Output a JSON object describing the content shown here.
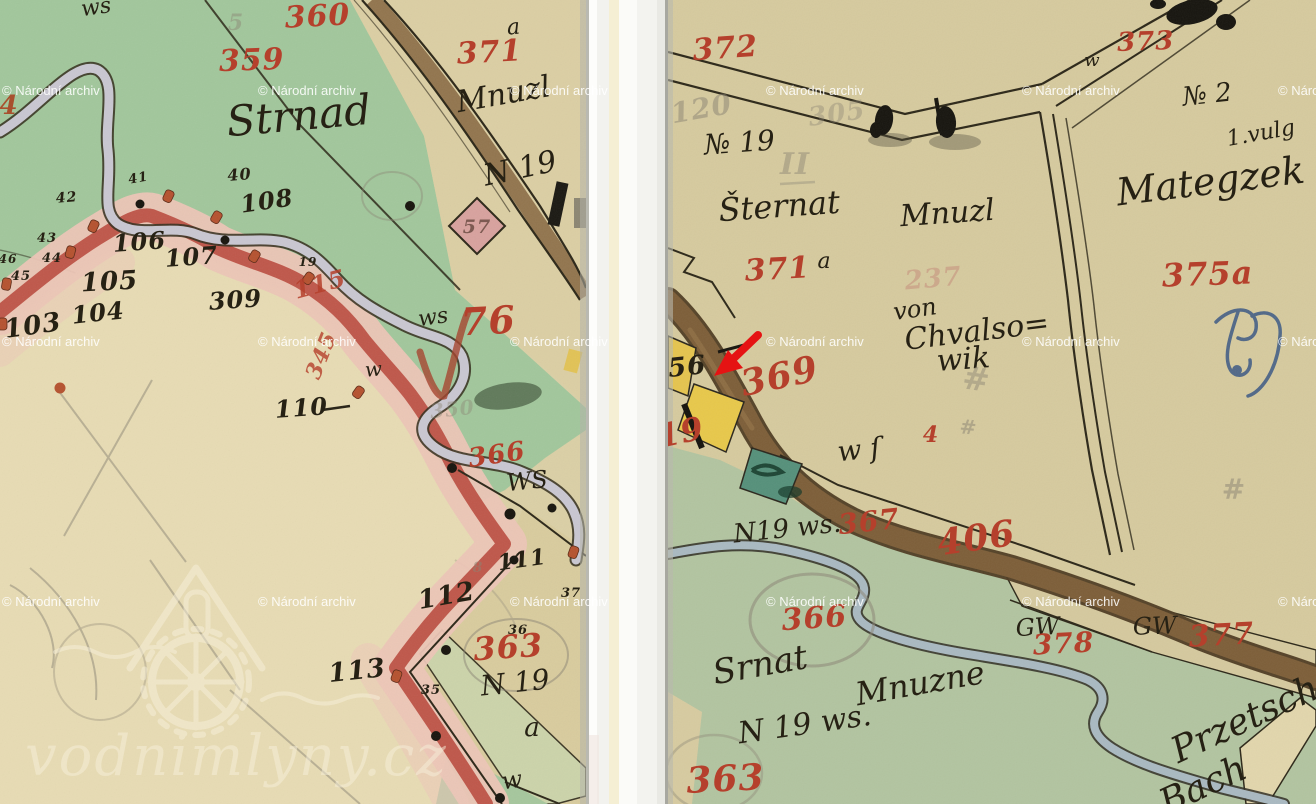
{
  "branding": {
    "archive_watermark": "© Národní archiv",
    "site_watermark": "vodnimlyny.cz"
  },
  "palette": {
    "red": "#b5402c",
    "black": "#262114",
    "pencil": "#8b8474",
    "pencil_red": "#c28376",
    "blue": "#3a5884",
    "rust": "#a8502e",
    "plum": "#7d5a52",
    "watermark": "#ffffff"
  },
  "annotation": {
    "arrow_color": "#e51313"
  },
  "watermarks": {
    "rows_y": [
      95,
      346,
      606
    ],
    "cols_x": [
      2,
      258,
      510,
      766,
      1022,
      1278
    ]
  },
  "map_labels": {
    "left": [
      {
        "t": "ws",
        "x": 97,
        "y": 14,
        "s": 22,
        "c": "black",
        "f": "hand",
        "r": -8
      },
      {
        "t": "5",
        "x": 236,
        "y": 30,
        "s": 22,
        "c": "pencil",
        "f": "num",
        "o": 0.45
      },
      {
        "t": "360",
        "x": 318,
        "y": 26,
        "s": 30,
        "c": "red",
        "f": "num",
        "r": -3
      },
      {
        "t": "a",
        "x": 514,
        "y": 34,
        "s": 22,
        "c": "black",
        "f": "hand",
        "r": -5
      },
      {
        "t": "371",
        "x": 490,
        "y": 62,
        "s": 30,
        "c": "red",
        "f": "num",
        "r": -3
      },
      {
        "t": "359",
        "x": 252,
        "y": 70,
        "s": 30,
        "c": "red",
        "f": "num",
        "r": -2
      },
      {
        "t": "Mnuzl",
        "x": 505,
        "y": 104,
        "s": 30,
        "c": "black",
        "f": "hand",
        "r": -10
      },
      {
        "t": "4",
        "x": 9,
        "y": 114,
        "s": 26,
        "c": "rust",
        "f": "num"
      },
      {
        "t": "Strnad",
        "x": 300,
        "y": 130,
        "s": 42,
        "c": "black",
        "f": "hand",
        "r": -5
      },
      {
        "t": "N 19",
        "x": 522,
        "y": 178,
        "s": 30,
        "c": "black",
        "f": "hand",
        "r": -12
      },
      {
        "t": "41",
        "x": 139,
        "y": 182,
        "s": 13,
        "c": "black",
        "f": "num",
        "r": -10
      },
      {
        "t": "40",
        "x": 240,
        "y": 180,
        "s": 16,
        "c": "black",
        "f": "num",
        "r": -5
      },
      {
        "t": "42",
        "x": 67,
        "y": 202,
        "s": 14,
        "c": "black",
        "f": "num",
        "r": -5
      },
      {
        "t": "108",
        "x": 268,
        "y": 209,
        "s": 24,
        "c": "black",
        "f": "num",
        "r": -8
      },
      {
        "t": "57",
        "x": 477,
        "y": 233,
        "s": 19,
        "c": "plum",
        "f": "num"
      },
      {
        "t": "43",
        "x": 47,
        "y": 242,
        "s": 13,
        "c": "black",
        "f": "num"
      },
      {
        "t": "106",
        "x": 140,
        "y": 250,
        "s": 24,
        "c": "black",
        "f": "num",
        "r": -4
      },
      {
        "t": "44",
        "x": 52,
        "y": 262,
        "s": 13,
        "c": "black",
        "f": "num"
      },
      {
        "t": "46",
        "x": 8,
        "y": 263,
        "s": 12,
        "c": "black",
        "f": "num"
      },
      {
        "t": "107",
        "x": 192,
        "y": 265,
        "s": 24,
        "c": "black",
        "f": "num",
        "r": -4
      },
      {
        "t": "19",
        "x": 308,
        "y": 266,
        "s": 12,
        "c": "black",
        "f": "num"
      },
      {
        "t": "45",
        "x": 21,
        "y": 280,
        "s": 13,
        "c": "black",
        "f": "num"
      },
      {
        "t": "105",
        "x": 110,
        "y": 290,
        "s": 26,
        "c": "black",
        "f": "num",
        "r": -3
      },
      {
        "t": "115",
        "x": 322,
        "y": 292,
        "s": 24,
        "c": "red",
        "f": "num",
        "r": -15,
        "o": 0.85
      },
      {
        "t": "309",
        "x": 236,
        "y": 308,
        "s": 24,
        "c": "black",
        "f": "num",
        "r": -4
      },
      {
        "t": "104",
        "x": 99,
        "y": 321,
        "s": 24,
        "c": "black",
        "f": "num",
        "r": -6
      },
      {
        "t": "ws",
        "x": 434,
        "y": 324,
        "s": 22,
        "c": "black",
        "f": "hand",
        "r": -8
      },
      {
        "t": "103",
        "x": 34,
        "y": 334,
        "s": 26,
        "c": "black",
        "f": "num",
        "r": -8
      },
      {
        "t": "76",
        "x": 489,
        "y": 334,
        "s": 38,
        "c": "red",
        "f": "num",
        "r": -3
      },
      {
        "t": "345",
        "x": 328,
        "y": 358,
        "s": 22,
        "c": "red",
        "f": "num",
        "r": -68,
        "o": 0.8
      },
      {
        "t": "w",
        "x": 374,
        "y": 376,
        "s": 20,
        "c": "black",
        "f": "hand",
        "r": -5
      },
      {
        "t": "110",
        "x": 302,
        "y": 416,
        "s": 24,
        "c": "black",
        "f": "num",
        "r": -4
      },
      {
        "t": "350",
        "x": 453,
        "y": 416,
        "s": 20,
        "c": "pencil",
        "f": "num",
        "r": -6,
        "o": 0.4
      },
      {
        "t": "366",
        "x": 498,
        "y": 463,
        "s": 26,
        "c": "red",
        "f": "num",
        "r": -8
      },
      {
        "t": "WS",
        "x": 528,
        "y": 489,
        "s": 24,
        "c": "black",
        "f": "hand",
        "r": -6
      },
      {
        "t": "111",
        "x": 523,
        "y": 567,
        "s": 22,
        "c": "black",
        "f": "num",
        "r": -8
      },
      {
        "t": "8",
        "x": 478,
        "y": 572,
        "s": 14,
        "c": "pencil",
        "f": "num",
        "o": 0.5
      },
      {
        "t": "112",
        "x": 448,
        "y": 604,
        "s": 26,
        "c": "black",
        "f": "num",
        "r": -10
      },
      {
        "t": "37",
        "x": 571,
        "y": 597,
        "s": 13,
        "c": "black",
        "f": "num"
      },
      {
        "t": "36",
        "x": 518,
        "y": 634,
        "s": 13,
        "c": "black",
        "f": "num"
      },
      {
        "t": "363",
        "x": 509,
        "y": 658,
        "s": 32,
        "c": "red",
        "f": "num",
        "r": -4
      },
      {
        "t": "35",
        "x": 431,
        "y": 694,
        "s": 13,
        "c": "black",
        "f": "num"
      },
      {
        "t": "113",
        "x": 358,
        "y": 679,
        "s": 26,
        "c": "black",
        "f": "num",
        "r": -6
      },
      {
        "t": "N 19",
        "x": 516,
        "y": 692,
        "s": 28,
        "c": "black",
        "f": "hand",
        "r": -6
      },
      {
        "t": "a",
        "x": 532,
        "y": 736,
        "s": 26,
        "c": "black",
        "f": "hand"
      },
      {
        "t": "w",
        "x": 513,
        "y": 788,
        "s": 24,
        "c": "black",
        "f": "hand",
        "r": -8
      }
    ],
    "right": [
      {
        "t": "372",
        "x": 726,
        "y": 58,
        "s": 30,
        "c": "red",
        "f": "num",
        "r": -4
      },
      {
        "t": "373",
        "x": 1146,
        "y": 50,
        "s": 26,
        "c": "red",
        "f": "num",
        "r": -2
      },
      {
        "t": "w",
        "x": 1092,
        "y": 66,
        "s": 18,
        "c": "black",
        "f": "hand"
      },
      {
        "t": "№ 2",
        "x": 1208,
        "y": 103,
        "s": 26,
        "c": "black",
        "f": "hand",
        "r": -6
      },
      {
        "t": "120",
        "x": 703,
        "y": 118,
        "s": 28,
        "c": "pencil",
        "f": "num",
        "r": -10,
        "o": 0.5
      },
      {
        "t": "305",
        "x": 838,
        "y": 122,
        "s": 26,
        "c": "pencil",
        "f": "num",
        "r": -8,
        "o": 0.38
      },
      {
        "t": "1.vulg",
        "x": 1262,
        "y": 140,
        "s": 22,
        "c": "black",
        "f": "hand",
        "r": -10
      },
      {
        "t": "№ 19",
        "x": 740,
        "y": 152,
        "s": 28,
        "c": "black",
        "f": "hand",
        "r": -4
      },
      {
        "t": "II",
        "x": 795,
        "y": 174,
        "s": 30,
        "c": "pencil",
        "f": "num",
        "o": 0.45
      },
      {
        "t": "Mategzek",
        "x": 1212,
        "y": 194,
        "s": 38,
        "c": "black",
        "f": "hand",
        "r": -7
      },
      {
        "t": "Šternat",
        "x": 780,
        "y": 217,
        "s": 32,
        "c": "black",
        "f": "hand",
        "r": -4
      },
      {
        "t": "Mnuzl",
        "x": 948,
        "y": 223,
        "s": 30,
        "c": "black",
        "f": "hand",
        "r": -4
      },
      {
        "t": "a",
        "x": 824,
        "y": 268,
        "s": 22,
        "c": "black",
        "f": "hand"
      },
      {
        "t": "371",
        "x": 778,
        "y": 279,
        "s": 30,
        "c": "red",
        "f": "num",
        "r": -3
      },
      {
        "t": "237",
        "x": 934,
        "y": 287,
        "s": 26,
        "c": "pencil_red",
        "f": "num",
        "r": -5,
        "o": 0.45
      },
      {
        "t": "375a",
        "x": 1208,
        "y": 285,
        "s": 32,
        "c": "red",
        "f": "num",
        "r": -2
      },
      {
        "t": "von",
        "x": 916,
        "y": 317,
        "s": 24,
        "c": "black",
        "f": "hand",
        "r": -8
      },
      {
        "t": "Chvalso=",
        "x": 978,
        "y": 341,
        "s": 30,
        "c": "black",
        "f": "hand",
        "r": -7
      },
      {
        "t": "wik",
        "x": 964,
        "y": 369,
        "s": 30,
        "c": "black",
        "f": "hand",
        "r": -4
      },
      {
        "t": "56",
        "x": 688,
        "y": 375,
        "s": 26,
        "c": "black",
        "f": "num",
        "r": -6
      },
      {
        "t": "369",
        "x": 782,
        "y": 388,
        "s": 36,
        "c": "red",
        "f": "num",
        "r": -12
      },
      {
        "t": "#",
        "x": 975,
        "y": 390,
        "s": 32,
        "c": "pencil",
        "f": "num",
        "r": 8,
        "o": 0.45
      },
      {
        "t": "19",
        "x": 683,
        "y": 443,
        "s": 32,
        "c": "red",
        "f": "num",
        "r": -12
      },
      {
        "t": "4",
        "x": 931,
        "y": 442,
        "s": 22,
        "c": "red",
        "f": "num"
      },
      {
        "t": "#",
        "x": 968,
        "y": 434,
        "s": 20,
        "c": "pencil",
        "f": "num",
        "r": 5,
        "o": 0.5
      },
      {
        "t": "w ſ",
        "x": 860,
        "y": 459,
        "s": 28,
        "c": "black",
        "f": "hand",
        "r": -6
      },
      {
        "t": "#",
        "x": 1234,
        "y": 499,
        "s": 28,
        "c": "pencil",
        "f": "num",
        "o": 0.5
      },
      {
        "t": "N19 ws.",
        "x": 788,
        "y": 537,
        "s": 26,
        "c": "black",
        "f": "hand",
        "r": -6
      },
      {
        "t": "367",
        "x": 870,
        "y": 531,
        "s": 28,
        "c": "red",
        "f": "num",
        "r": -6
      },
      {
        "t": "406",
        "x": 978,
        "y": 550,
        "s": 36,
        "c": "red",
        "f": "num",
        "r": -8
      },
      {
        "t": "366",
        "x": 815,
        "y": 628,
        "s": 30,
        "c": "red",
        "f": "num",
        "r": -4
      },
      {
        "t": "GW",
        "x": 1038,
        "y": 635,
        "s": 24,
        "c": "black",
        "f": "hand",
        "r": -3
      },
      {
        "t": "GW",
        "x": 1155,
        "y": 634,
        "s": 24,
        "c": "black",
        "f": "hand",
        "r": -2
      },
      {
        "t": "378",
        "x": 1064,
        "y": 653,
        "s": 28,
        "c": "red",
        "f": "num",
        "r": -3
      },
      {
        "t": "377",
        "x": 1222,
        "y": 645,
        "s": 30,
        "c": "red",
        "f": "num",
        "r": -3
      },
      {
        "t": "Srnat",
        "x": 762,
        "y": 676,
        "s": 34,
        "c": "black",
        "f": "hand",
        "r": -10
      },
      {
        "t": "Mnuzne",
        "x": 922,
        "y": 694,
        "s": 32,
        "c": "black",
        "f": "hand",
        "r": -10
      },
      {
        "t": "N 19 ws.",
        "x": 806,
        "y": 734,
        "s": 30,
        "c": "black",
        "f": "hand",
        "r": -8
      },
      {
        "t": "Przetsch",
        "x": 1250,
        "y": 730,
        "s": 36,
        "c": "black",
        "f": "hand",
        "r": -25
      },
      {
        "t": "363",
        "x": 726,
        "y": 791,
        "s": 36,
        "c": "red",
        "f": "num",
        "r": -3
      },
      {
        "t": "Bach",
        "x": 1208,
        "y": 796,
        "s": 36,
        "c": "black",
        "f": "hand",
        "r": -25
      }
    ]
  }
}
